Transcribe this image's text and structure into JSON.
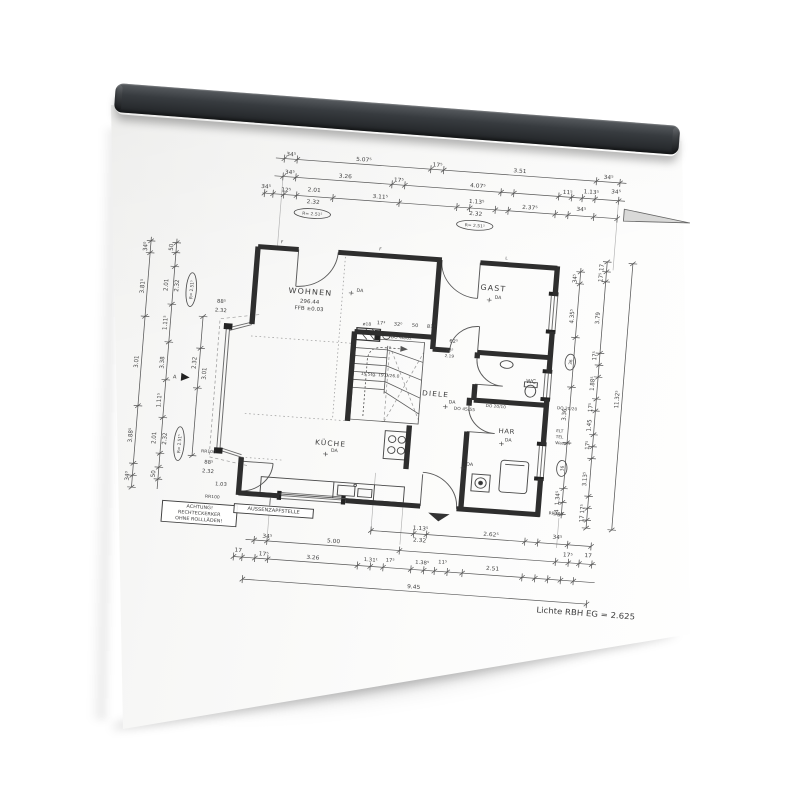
{
  "colors": {
    "background": "#ffffff",
    "rail": "#383c40",
    "paper": "#fafaf9",
    "ink": "#3f3f3f"
  },
  "plan": {
    "footer": "Lichte RBH EG = 2.625",
    "texts": [
      {
        "x": 154,
        "y": 29,
        "t": "34⁵"
      },
      {
        "x": 222,
        "y": 29,
        "t": "5.07⁵"
      },
      {
        "x": 291,
        "y": 29,
        "t": "17⁵"
      },
      {
        "x": 368,
        "y": 29,
        "t": "3.51"
      },
      {
        "x": 451,
        "y": 29,
        "t": "34⁵"
      },
      {
        "x": 154,
        "y": 47,
        "t": "34⁵"
      },
      {
        "x": 206,
        "y": 47,
        "t": "3.26"
      },
      {
        "x": 256,
        "y": 47,
        "t": "17⁵"
      },
      {
        "x": 330,
        "y": 47,
        "t": "4.07⁵"
      },
      {
        "x": 414,
        "y": 47,
        "t": "11⁵"
      },
      {
        "x": 436,
        "y": 45,
        "t": "1.13⁵"
      },
      {
        "x": 459,
        "y": 43,
        "t": "34⁵"
      },
      {
        "x": 133,
        "y": 63,
        "t": "34⁵"
      },
      {
        "x": 152,
        "y": 65,
        "t": "12⁵"
      },
      {
        "x": 178,
        "y": 63,
        "t": "2.01"
      },
      {
        "x": 178,
        "y": 75,
        "t": "2.32"
      },
      {
        "x": 240,
        "y": 65,
        "t": "3.11⁵"
      },
      {
        "x": 330,
        "y": 63,
        "t": "1.13⁵"
      },
      {
        "x": 330,
        "y": 75,
        "t": "2.32"
      },
      {
        "x": 380,
        "y": 65,
        "t": "2.37⁵"
      },
      {
        "x": 428,
        "y": 63,
        "t": "34⁵"
      },
      {
        "x": 182,
        "y": 166,
        "t": "WOHNEN",
        "s": 7.5,
        "ls": 1,
        "n": "room-label-wohnen"
      },
      {
        "x": 182,
        "y": 175,
        "t": "296.44",
        "s": 5.2
      },
      {
        "x": 182,
        "y": 182,
        "t": "FFB ±0.03",
        "s": 5.2
      },
      {
        "x": 352,
        "y": 149,
        "t": "GAST",
        "s": 7.5,
        "ls": 1,
        "n": "room-label-gast"
      },
      {
        "x": 306,
        "y": 259,
        "t": "DIELE",
        "s": 7,
        "ls": 1,
        "n": "room-label-diele"
      },
      {
        "x": 212,
        "y": 316,
        "t": "KÜCHE",
        "s": 7,
        "ls": 1,
        "n": "room-label-kueche"
      },
      {
        "x": 375,
        "y": 291,
        "t": "HAR",
        "s": 6.5,
        "ls": 0.5,
        "n": "room-label-har"
      },
      {
        "x": 394,
        "y": 239,
        "t": "WC",
        "s": 5.5,
        "n": "room-label-wc"
      },
      {
        "x": 220,
        "y": 164,
        "t": "+",
        "s": 7
      },
      {
        "x": 228,
        "y": 160,
        "t": "DA",
        "s": 4.5
      },
      {
        "x": 349,
        "y": 161,
        "t": "+",
        "s": 7
      },
      {
        "x": 357,
        "y": 157,
        "t": "DA",
        "s": 4.5
      },
      {
        "x": 316,
        "y": 271,
        "t": "+",
        "s": 7
      },
      {
        "x": 322,
        "y": 265,
        "t": "DA",
        "s": 4.5
      },
      {
        "x": 208,
        "y": 327,
        "t": "+",
        "s": 7
      },
      {
        "x": 216,
        "y": 322,
        "t": "DA",
        "s": 4.5
      },
      {
        "x": 371,
        "y": 304,
        "t": "+",
        "s": 7
      },
      {
        "x": 377,
        "y": 299,
        "t": "DA",
        "s": 4.5
      },
      {
        "x": 337,
        "y": 331,
        "t": "+",
        "s": 7
      },
      {
        "x": 343,
        "y": 326,
        "t": "DA",
        "s": 4.5
      },
      {
        "x": 250,
        "y": 191,
        "t": "17³",
        "s": 4.8
      },
      {
        "x": 266,
        "y": 191,
        "t": "32⁰",
        "s": 4.8
      },
      {
        "x": 282,
        "y": 191,
        "t": "50",
        "s": 4.8
      },
      {
        "x": 297,
        "y": 191,
        "t": "81⁵",
        "s": 4.8
      },
      {
        "x": 319,
        "y": 204,
        "t": "62⁵",
        "s": 4.8
      },
      {
        "x": 237,
        "y": 193,
        "t": "ø18",
        "s": 4.2
      },
      {
        "x": 270,
        "y": 204,
        "t": "DO 46/62",
        "s": 4.2
      },
      {
        "x": 253,
        "y": 243,
        "t": "15 Stg. 19.0/26.0",
        "s": 4.2
      },
      {
        "x": 334,
        "y": 271,
        "t": "DO 45/55",
        "s": 4.2
      },
      {
        "x": 363,
        "y": 266,
        "t": "DO 20/10",
        "s": 4
      },
      {
        "x": 420,
        "y": 263,
        "t": "DO 20/20",
        "s": 4,
        "a": "start"
      },
      {
        "x": 421,
        "y": 286,
        "t": "ELT",
        "s": 4,
        "a": "start"
      },
      {
        "x": 421,
        "y": 292,
        "t": "TEL",
        "s": 4,
        "a": "start"
      },
      {
        "x": 421,
        "y": 298,
        "t": "Wasser",
        "s": 4,
        "a": "start"
      },
      {
        "x": 420,
        "y": 369,
        "t": "RR100",
        "s": 4.2,
        "a": "start"
      },
      {
        "x": 99,
        "y": 332,
        "t": "RR100",
        "s": 4.2
      },
      {
        "x": 106,
        "y": 377,
        "t": "RR100",
        "s": 4.2
      },
      {
        "x": 316,
        "y": 213,
        "t": "88⁵",
        "s": 4
      },
      {
        "x": 316,
        "y": 219,
        "t": "2.19",
        "s": 4
      },
      {
        "x": 100,
        "y": 181,
        "t": "88⁵",
        "s": 5
      },
      {
        "x": 100,
        "y": 190,
        "t": "2.32",
        "s": 5
      },
      {
        "x": 100,
        "y": 343,
        "t": "88⁵",
        "s": 5
      },
      {
        "x": 100,
        "y": 352,
        "t": "2.32",
        "s": 5
      },
      {
        "x": 113,
        "y": 364,
        "t": "1.03",
        "s": 5
      },
      {
        "x": 152,
        "y": 117,
        "t": "F",
        "s": 4
      },
      {
        "x": 244,
        "y": 117,
        "t": "F",
        "s": 4
      },
      {
        "x": 362,
        "y": 117,
        "t": "L",
        "s": 4
      },
      {
        "x": 27,
        "y": 130,
        "t": "34⁰",
        "r": -90
      },
      {
        "x": 27,
        "y": 170,
        "t": "3.81⁵",
        "r": -90
      },
      {
        "x": 27,
        "y": 246,
        "t": "3.01",
        "r": -90
      },
      {
        "x": 27,
        "y": 320,
        "t": "3.88⁵",
        "r": -90
      },
      {
        "x": 27,
        "y": 361,
        "t": "34⁰",
        "r": -90
      },
      {
        "x": 51,
        "y": 129,
        "t": "50",
        "r": -90
      },
      {
        "x": 49,
        "y": 167,
        "t": "2.01",
        "r": -90
      },
      {
        "x": 59,
        "y": 167,
        "t": "2.32",
        "r": -90
      },
      {
        "x": 51,
        "y": 205,
        "t": "1.11⁵",
        "r": -90
      },
      {
        "x": 51,
        "y": 245,
        "t": "3.38",
        "r": -90
      },
      {
        "x": 51,
        "y": 283,
        "t": "1.11⁵",
        "r": -90
      },
      {
        "x": 49,
        "y": 321,
        "t": "2.01",
        "r": -90
      },
      {
        "x": 59,
        "y": 321,
        "t": "2.32",
        "r": -90
      },
      {
        "x": 51,
        "y": 357,
        "t": "50",
        "r": -90
      },
      {
        "x": 81,
        "y": 243,
        "t": "2.32",
        "r": -90
      },
      {
        "x": 91,
        "y": 253,
        "t": "3.01",
        "r": -90
      },
      {
        "x": 62,
        "y": 260,
        "t": "A",
        "s": 5
      },
      {
        "x": 429,
        "y": 131,
        "t": "34⁵",
        "r": -90
      },
      {
        "x": 429,
        "y": 169,
        "t": "4.35⁵",
        "r": -90
      },
      {
        "x": 429,
        "y": 268,
        "t": "3.36",
        "r": -90
      },
      {
        "x": 429,
        "y": 352,
        "t": "1.34⁵",
        "r": -90
      },
      {
        "x": 429,
        "y": 367,
        "t": "34",
        "r": -90
      },
      {
        "x": 453,
        "y": 118,
        "t": "17",
        "r": -90
      },
      {
        "x": 453,
        "y": 128,
        "t": "17⁵",
        "r": -90
      },
      {
        "x": 453,
        "y": 169,
        "t": "3.79",
        "r": -90
      },
      {
        "x": 453,
        "y": 207,
        "t": "17⁵",
        "r": -90
      },
      {
        "x": 453,
        "y": 235,
        "t": "1.88⁵",
        "r": -90
      },
      {
        "x": 453,
        "y": 259,
        "t": "17⁵",
        "r": -90
      },
      {
        "x": 453,
        "y": 277,
        "t": "1.45",
        "r": -90
      },
      {
        "x": 453,
        "y": 297,
        "t": "17⁵",
        "r": -90
      },
      {
        "x": 453,
        "y": 331,
        "t": "3.13⁵",
        "r": -90
      },
      {
        "x": 453,
        "y": 361,
        "t": "17⁵",
        "r": -90
      },
      {
        "x": 453,
        "y": 371,
        "t": "17",
        "r": -90
      },
      {
        "x": 477,
        "y": 249,
        "t": "11.32⁵",
        "r": -90
      },
      {
        "x": 302,
        "y": 394,
        "t": "1.13⁵"
      },
      {
        "x": 302,
        "y": 406,
        "t": "2.32"
      },
      {
        "x": 368,
        "y": 395,
        "t": "2.62⁵"
      },
      {
        "x": 430,
        "y": 393,
        "t": "34⁵"
      },
      {
        "x": 160,
        "y": 413,
        "t": "34⁵"
      },
      {
        "x": 222,
        "y": 413,
        "t": "5.00"
      },
      {
        "x": 441,
        "y": 410,
        "t": "17⁵"
      },
      {
        "x": 460,
        "y": 409,
        "t": "17"
      },
      {
        "x": 134,
        "y": 429,
        "t": "17"
      },
      {
        "x": 158,
        "y": 431,
        "t": "17⁵"
      },
      {
        "x": 204,
        "y": 431,
        "t": "3.26"
      },
      {
        "x": 258,
        "y": 429,
        "t": "1.31¹",
        "s": 5
      },
      {
        "x": 276,
        "y": 428,
        "t": "17⁵",
        "s": 5
      },
      {
        "x": 306,
        "y": 428,
        "t": "1.38⁵",
        "s": 5
      },
      {
        "x": 325,
        "y": 426,
        "t": "11⁵",
        "s": 5
      },
      {
        "x": 372,
        "y": 429,
        "t": "2.51"
      },
      {
        "x": 300,
        "y": 453,
        "t": "9.45"
      }
    ],
    "ovals": [
      {
        "x": 178,
        "y": 85,
        "t": "R= 2.51⁵",
        "w": 34
      },
      {
        "x": 330,
        "y": 85,
        "t": "R= 2.51⁵",
        "w": 34
      },
      {
        "x": 71,
        "y": 170,
        "t": "R= 2.51⁵",
        "w": 34,
        "r": -90
      },
      {
        "x": 71,
        "y": 325,
        "t": "R= 2.51⁵",
        "w": 34,
        "r": -90
      },
      {
        "x": 429,
        "y": 215,
        "t": "36",
        "w": 16,
        "r": -90
      },
      {
        "x": 429,
        "y": 322,
        "t": "36",
        "w": 16,
        "r": -90
      }
    ],
    "boxes": [
      {
        "x": 60,
        "y": 383,
        "w": 70,
        "h": 21,
        "s": 4.6,
        "n": "note-achtung",
        "lines": [
          "ACHTUNG!",
          "RECHTECKERKER",
          "OHNE ROLLLÄDEN!"
        ]
      },
      {
        "x": 127,
        "y": 381,
        "w": 74,
        "h": 9,
        "s": 4.8,
        "n": "note-aussenzapfstelle",
        "lines": [
          "AUSSENZAPFSTELLE"
        ]
      }
    ]
  }
}
